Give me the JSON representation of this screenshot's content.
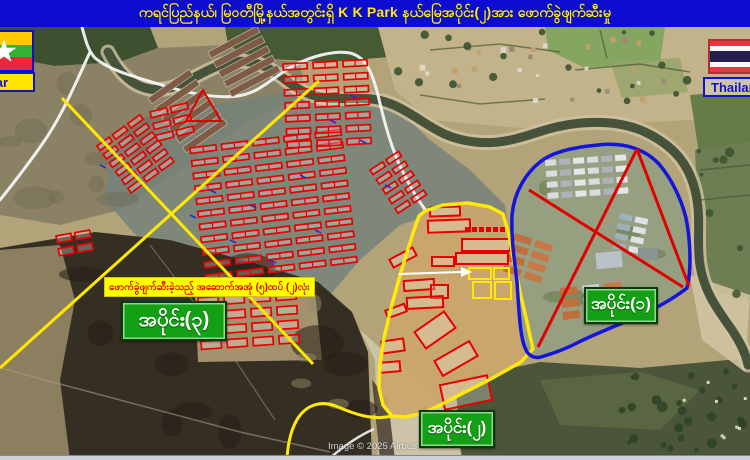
{
  "title": "ကရင်ပြည်နယ်၊ မြဝတီမြို့နယ်အတွင်းရှိ  K K Park နယ်မြေအပိုင်း(၂)အား  ဖောက်ခွဲဖျက်ဆီးမှု",
  "countries": {
    "myanmar": "Myanmar",
    "thailand": "Thailand"
  },
  "sections": {
    "s1": "အပိုင်း(၁)",
    "s2": "အပိုင်း(၂)",
    "s3": "အပိုင်း(၃)"
  },
  "annotation": "ဖောက်ခွဲဖျက်ဆီးခဲ့သည့် အဆောက်အအုံ (၅)ထပ် (၂)လုံး",
  "attribution": "Image © 2025 Airbus",
  "colors": {
    "title_bg": "#0d0dd0",
    "title_text": "#ffe81a",
    "section_label_bg": "#14a014",
    "annotation_bg": "#ffff00",
    "annotation_text": "#e00000",
    "boundary_section1": "#1414dd",
    "boundary_section2": "#ffe80a",
    "building_outline": "#e80000",
    "survey_line": "#ffe800",
    "road": "#f4f4f4"
  }
}
